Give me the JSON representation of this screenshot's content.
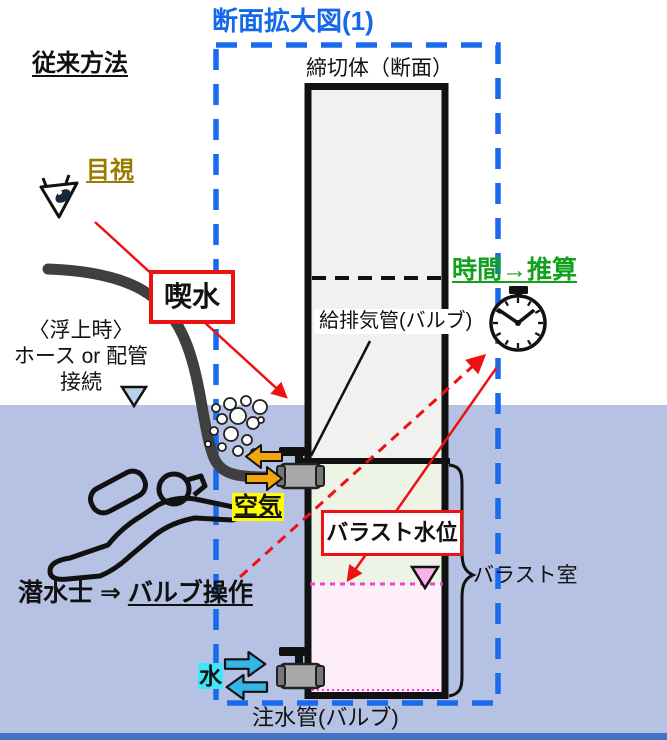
{
  "title": "断面拡大図(1)",
  "method_label": "従来方法",
  "tank": {
    "top_label": "締切体（断面）",
    "air_pipe_label": "給排気管(バルブ)",
    "water_pipe_label": "注水管(バルブ)",
    "ballast_room_label": "バラスト室"
  },
  "annotations": {
    "visual_check": "目視",
    "draft": "喫水",
    "time_estimate": "時間→推算",
    "air": "空気",
    "water": "水",
    "ballast_level": "バラスト水位",
    "diver_prefix": "潜水士 ⇒ ",
    "diver_action": "バルブ操作",
    "surfacing": {
      "line1": "〈浮上時〉",
      "line2": "ホース or 配管",
      "line3": "接続"
    }
  },
  "icons": {
    "eye": "eye-icon",
    "stopwatch": "stopwatch-icon",
    "diver": "diver-icon",
    "valve_top": "air-valve-icon",
    "valve_bottom": "water-valve-icon",
    "bubbles": "bubbles-icon",
    "air_arrows": "air-flow-arrows",
    "water_arrows": "water-flow-arrows"
  },
  "colors": {
    "frame_blue": "#1a6aee",
    "title_blue": "#1569e8",
    "water": "#b5c2e3",
    "deep_water": "#4472c4",
    "highlight_red": "#ee1111",
    "green_text": "#12a11c",
    "gold_text": "#9c7a00",
    "yellow_highlight": "#ffff00",
    "cyan_highlight": "#3ee6f8",
    "air_arrow_orange": "#f2a50c",
    "water_arrow_cyan": "#35b6e9",
    "tank_fill": "#f1f2f0",
    "ballast_air_fill": "#edf3e5",
    "ballast_water_fill": "#fdeefa",
    "level_magenta": "#ee44cc",
    "hose_gray": "#3f3f3f"
  }
}
